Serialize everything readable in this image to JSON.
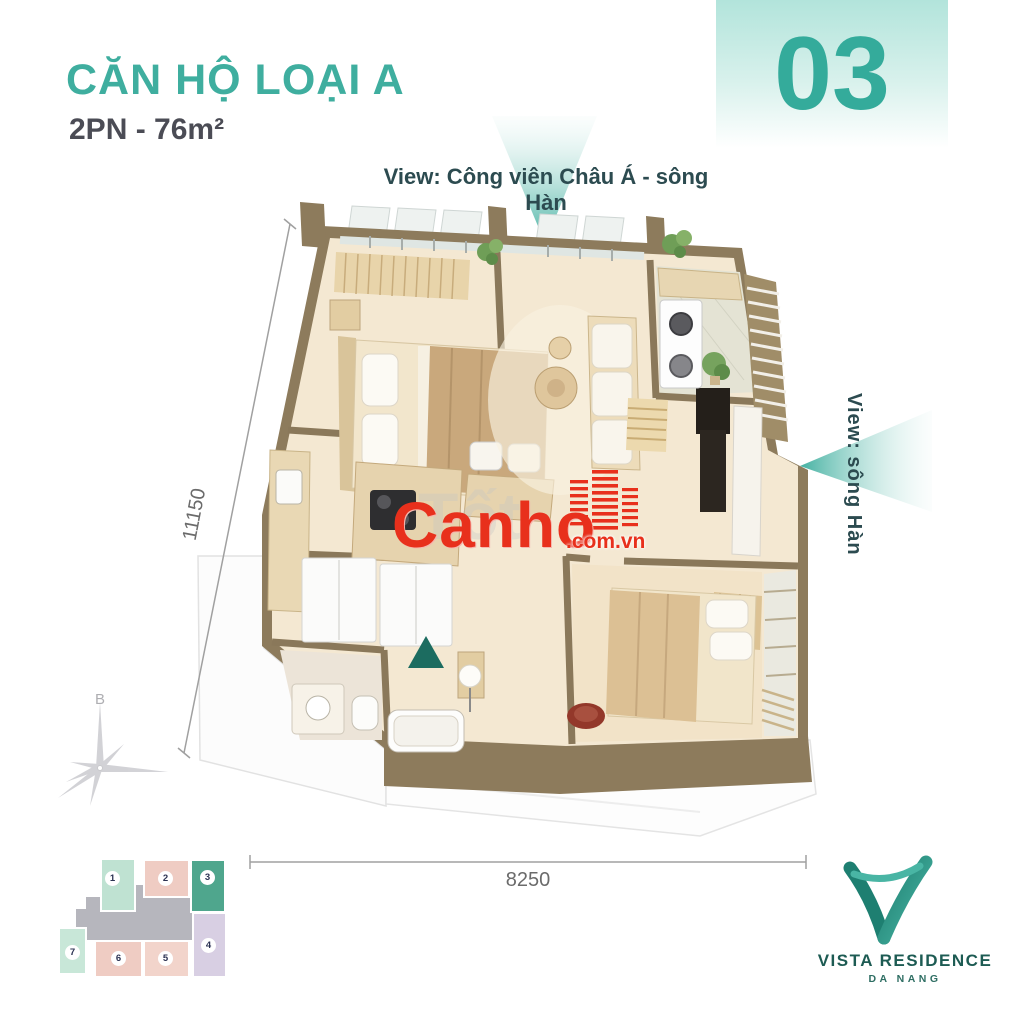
{
  "header": {
    "title": "CĂN HỘ LOẠI A",
    "subtitle": "2PN - 76m²",
    "unit_number": "03"
  },
  "views": {
    "top": "View: Công viên Châu Á - sông Hàn",
    "right": "View: sông Hàn"
  },
  "dimensions": {
    "vertical": "11150",
    "horizontal": "8250"
  },
  "compass": {
    "north_label": "B"
  },
  "watermark": {
    "brand": "Canho",
    "suffix": ".com.vn",
    "background_text": "Tốt"
  },
  "keyplan": {
    "highlighted_unit": "3",
    "units": [
      {
        "label": "1",
        "color": "#bfe2d2"
      },
      {
        "label": "2",
        "color": "#efccc3"
      },
      {
        "label": "3",
        "color": "#4fa68d"
      },
      {
        "label": "4",
        "color": "#d8cfe3"
      },
      {
        "label": "5",
        "color": "#f2d4cb"
      },
      {
        "label": "6",
        "color": "#efccc3"
      },
      {
        "label": "7",
        "color": "#c8e7d8"
      }
    ]
  },
  "logo": {
    "name": "VISTA RESIDENCE",
    "location": "DA NANG"
  },
  "colors": {
    "accent_teal": "#3fae9f",
    "unit_number_teal": "#34ab9b",
    "view_text": "#2c4b50",
    "wall_brown": "#8d7b5c",
    "floor_cream": "#f4e8d2",
    "watermark_red": "#e8301c",
    "entrance_marker": "#1c6c60",
    "dimension_gray": "#6b6b6b"
  }
}
